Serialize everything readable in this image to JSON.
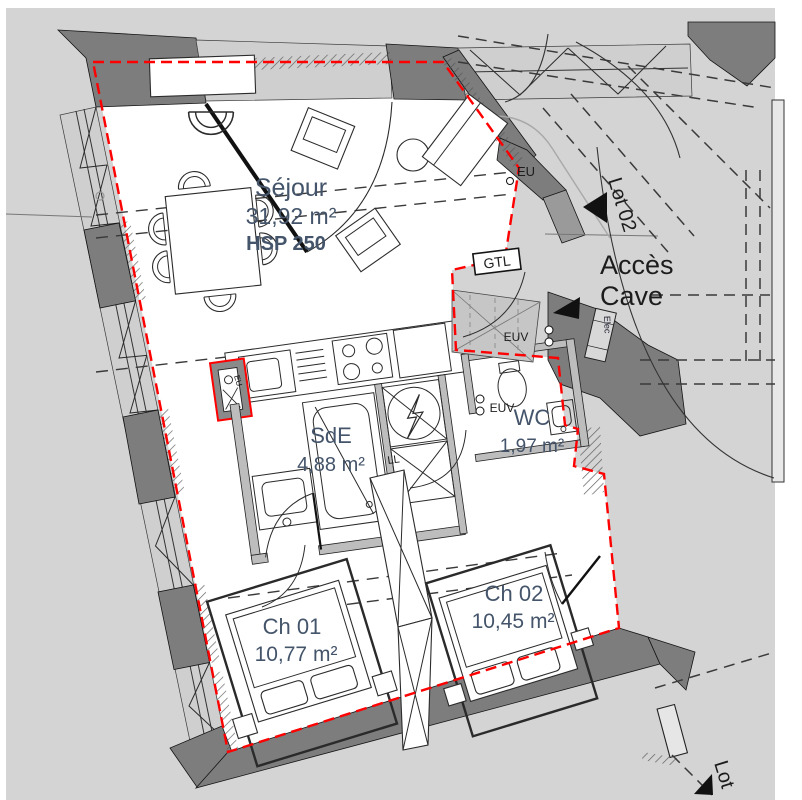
{
  "plan": {
    "type": "apartment-floor-plan",
    "language": "fr"
  },
  "colors": {
    "background": "#d4d4d4",
    "wall_dark": "#7d7d7d",
    "wall_light": "#cfcfcf",
    "interior": "#ffffff",
    "lot_boundary_red": "#ff0000",
    "room_label": "#44546a",
    "annotation": "#1c1c1c"
  },
  "rooms": [
    {
      "id": "sejour",
      "name": "Séjour",
      "area": "31,92 m²",
      "note": "HSP 250"
    },
    {
      "id": "sde",
      "name": "SdE",
      "area": "4,88 m²"
    },
    {
      "id": "wc",
      "name": "WC",
      "area": "1,97 m²"
    },
    {
      "id": "ch01",
      "name": "Ch 01",
      "area": "10,77 m²"
    },
    {
      "id": "ch02",
      "name": "Ch 02",
      "area": "10,45 m²"
    }
  ],
  "labels": {
    "acces_cave_line1": "Accès",
    "acces_cave_line2": "Cave",
    "lot_02": "Lot 02",
    "lot_bottom": "Lot",
    "gtl": "GTL",
    "eu": "EU",
    "eu_shaft": "EU",
    "euv_entry": "EUV",
    "euv_wc": "EUV",
    "elec": "Elec",
    "ll": "LL"
  }
}
